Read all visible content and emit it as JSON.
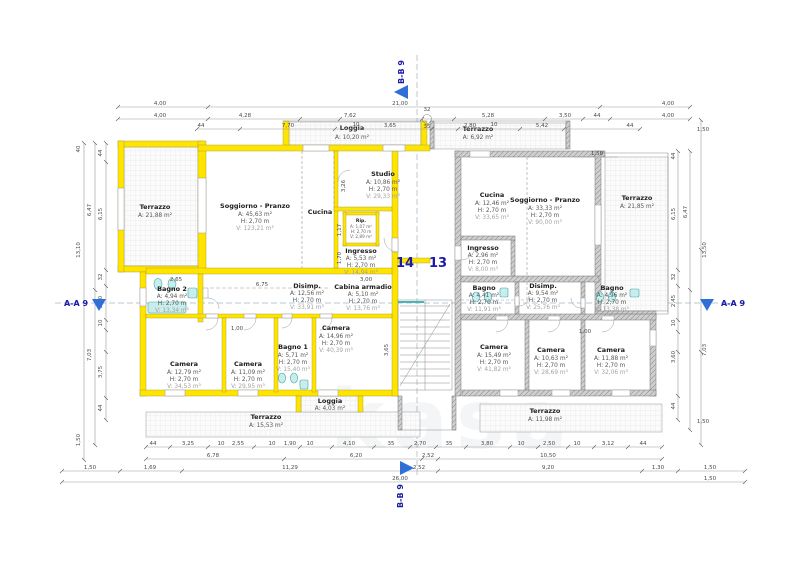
{
  "markers": {
    "aa": "A-A 9",
    "bb": "B-B 9"
  },
  "units": {
    "left": "14",
    "right": "13"
  },
  "watermark": "kasa",
  "apt14": {
    "terrazzo_left": {
      "name": "Terrazzo",
      "a": "A: 21,88 m²"
    },
    "loggia_top": {
      "name": "Loggia",
      "a": "A: 10,20 m²"
    },
    "soggiorno": {
      "name": "Soggiorno - Pranzo",
      "a": "A: 45,63 m²",
      "h": "H: 2,70 m",
      "v": "V: 123,21 m³"
    },
    "cucina": {
      "name": "Cucina"
    },
    "studio": {
      "name": "Studio",
      "a": "A: 10,86 m²",
      "h": "H: 2,70 m",
      "v": "V: 29,33 m³"
    },
    "rip": {
      "name": "Rip.",
      "a": "A: 1,07 m²",
      "h": "H: 2,70 m",
      "v": "V: 2,89 m³"
    },
    "ingresso": {
      "name": "Ingresso",
      "a": "A: 5,53 m²",
      "h": "H: 2,70 m",
      "v": "V: 14,94 m³"
    },
    "bagno2": {
      "name": "Bagno 2",
      "a": "A: 4,94 m²",
      "h": "H: 2,70 m",
      "v": "V: 13,34 m³"
    },
    "disimp": {
      "name": "Disimp.",
      "a": "A: 12,56 m²",
      "h": "H: 2,70 m",
      "v": "V: 33,91 m³"
    },
    "cabina": {
      "name": "Cabina armadio",
      "a": "A: 5,10 m²",
      "h": "H: 2,70 m",
      "v": "V: 13,76 m³"
    },
    "camera1": {
      "name": "Camera",
      "a": "A: 12,79 m²",
      "h": "H: 2,70 m",
      "v": "V: 34,53 m³"
    },
    "camera2": {
      "name": "Camera",
      "a": "A: 11,09 m²",
      "h": "H: 2,70 m",
      "v": "V: 29,95 m³"
    },
    "bagno1": {
      "name": "Bagno 1",
      "a": "A: 5,71 m²",
      "h": "H: 2,70 m",
      "v": "V: 15,40 m³"
    },
    "camera3": {
      "name": "Camera",
      "a": "A: 14,96 m²",
      "h": "H: 2,70 m",
      "v": "V: 40,39 m³"
    },
    "loggia_bottom": {
      "name": "Loggia",
      "a": "A: 4,03 m²"
    },
    "terrazzo_bottom": {
      "name": "Terrazzo",
      "a": "A: 15,53 m²"
    }
  },
  "apt13": {
    "terrazzo_top": {
      "name": "Terrazzo",
      "a": "A: 6,92 m²"
    },
    "cucina": {
      "name": "Cucina",
      "a": "A: 12,46 m²",
      "h": "H: 2,70 m",
      "v": "V: 33,65 m³"
    },
    "soggiorno": {
      "name": "Soggiorno - Pranzo",
      "a": "A: 33,33 m²",
      "h": "H: 2,70 m",
      "v": "V: 90,00 m³"
    },
    "terrazzo_right": {
      "name": "Terrazzo",
      "a": "A: 21,85 m²"
    },
    "ingresso": {
      "name": "Ingresso",
      "a": "A: 2,96 m²",
      "h": "H: 2,70 m",
      "v": "V: 8,00 m³"
    },
    "bagno_a": {
      "name": "Bagno",
      "a": "A: 4,41 m²",
      "h": "H: 2,70 m",
      "v": "V: 11,91 m³"
    },
    "disimp": {
      "name": "Disimp.",
      "a": "A: 9,54 m²",
      "h": "H: 2,70 m",
      "v": "V: 25,76 m³"
    },
    "bagno_b": {
      "name": "Bagno",
      "a": "A: 4,96 m²",
      "h": "H: 2,70 m",
      "v": "V: 13,38 m³"
    },
    "camera1": {
      "name": "Camera",
      "a": "A: 15,49 m²",
      "h": "H: 2,70 m",
      "v": "V: 41,82 m³"
    },
    "camera2": {
      "name": "Camera",
      "a": "A: 10,63 m²",
      "h": "H: 2,70 m",
      "v": "V: 28,69 m³"
    },
    "camera3": {
      "name": "Camera",
      "a": "A: 11,88 m²",
      "h": "H: 2,70 m",
      "v": "V: 32,06 m³"
    },
    "terrazzo_bottom": {
      "name": "Terrazzo",
      "a": "A: 11,98 m²"
    }
  },
  "dims": {
    "t1": [
      "4,00",
      "21,00",
      "4,00"
    ],
    "t2": [
      "4,00",
      "4,28",
      "7,62",
      "10",
      "32",
      "35",
      "5,28",
      "10",
      "3,50",
      "44",
      "4,00"
    ],
    "t3": [
      "44",
      "7,70",
      "3,65",
      "2,80",
      "5,42",
      "44"
    ],
    "b1": [
      "44",
      "3,25",
      "10",
      "2,55",
      "10",
      "1,90",
      "10",
      "4,10",
      "35",
      "2,70",
      "35",
      "3,80",
      "10",
      "2,50",
      "10",
      "3,12",
      "44"
    ],
    "b2": [
      "6,78",
      "6,20",
      "2,52",
      "10,50"
    ],
    "b3": [
      "1,50",
      "1,69",
      "11,29",
      "2,52",
      "9,20",
      "1,30",
      "1,50"
    ],
    "b4": [
      "26,00",
      "1,50"
    ],
    "l": [
      "40",
      "13,10",
      "1,50",
      "6,47",
      "7,03",
      "44",
      "6,15",
      "32",
      "2,30",
      "10",
      "3,75",
      "44"
    ],
    "r": [
      "1,50",
      "13,50",
      "7,03",
      "1,50",
      "6,47",
      "44",
      "6,15",
      "32",
      "2,45",
      "10",
      "3,60",
      "44"
    ],
    "inner": [
      "6,75",
      "3,00",
      "2,65",
      "1,00",
      "3,26",
      "1,17",
      "1,70",
      "3,65",
      "1,00",
      "1,50"
    ]
  }
}
